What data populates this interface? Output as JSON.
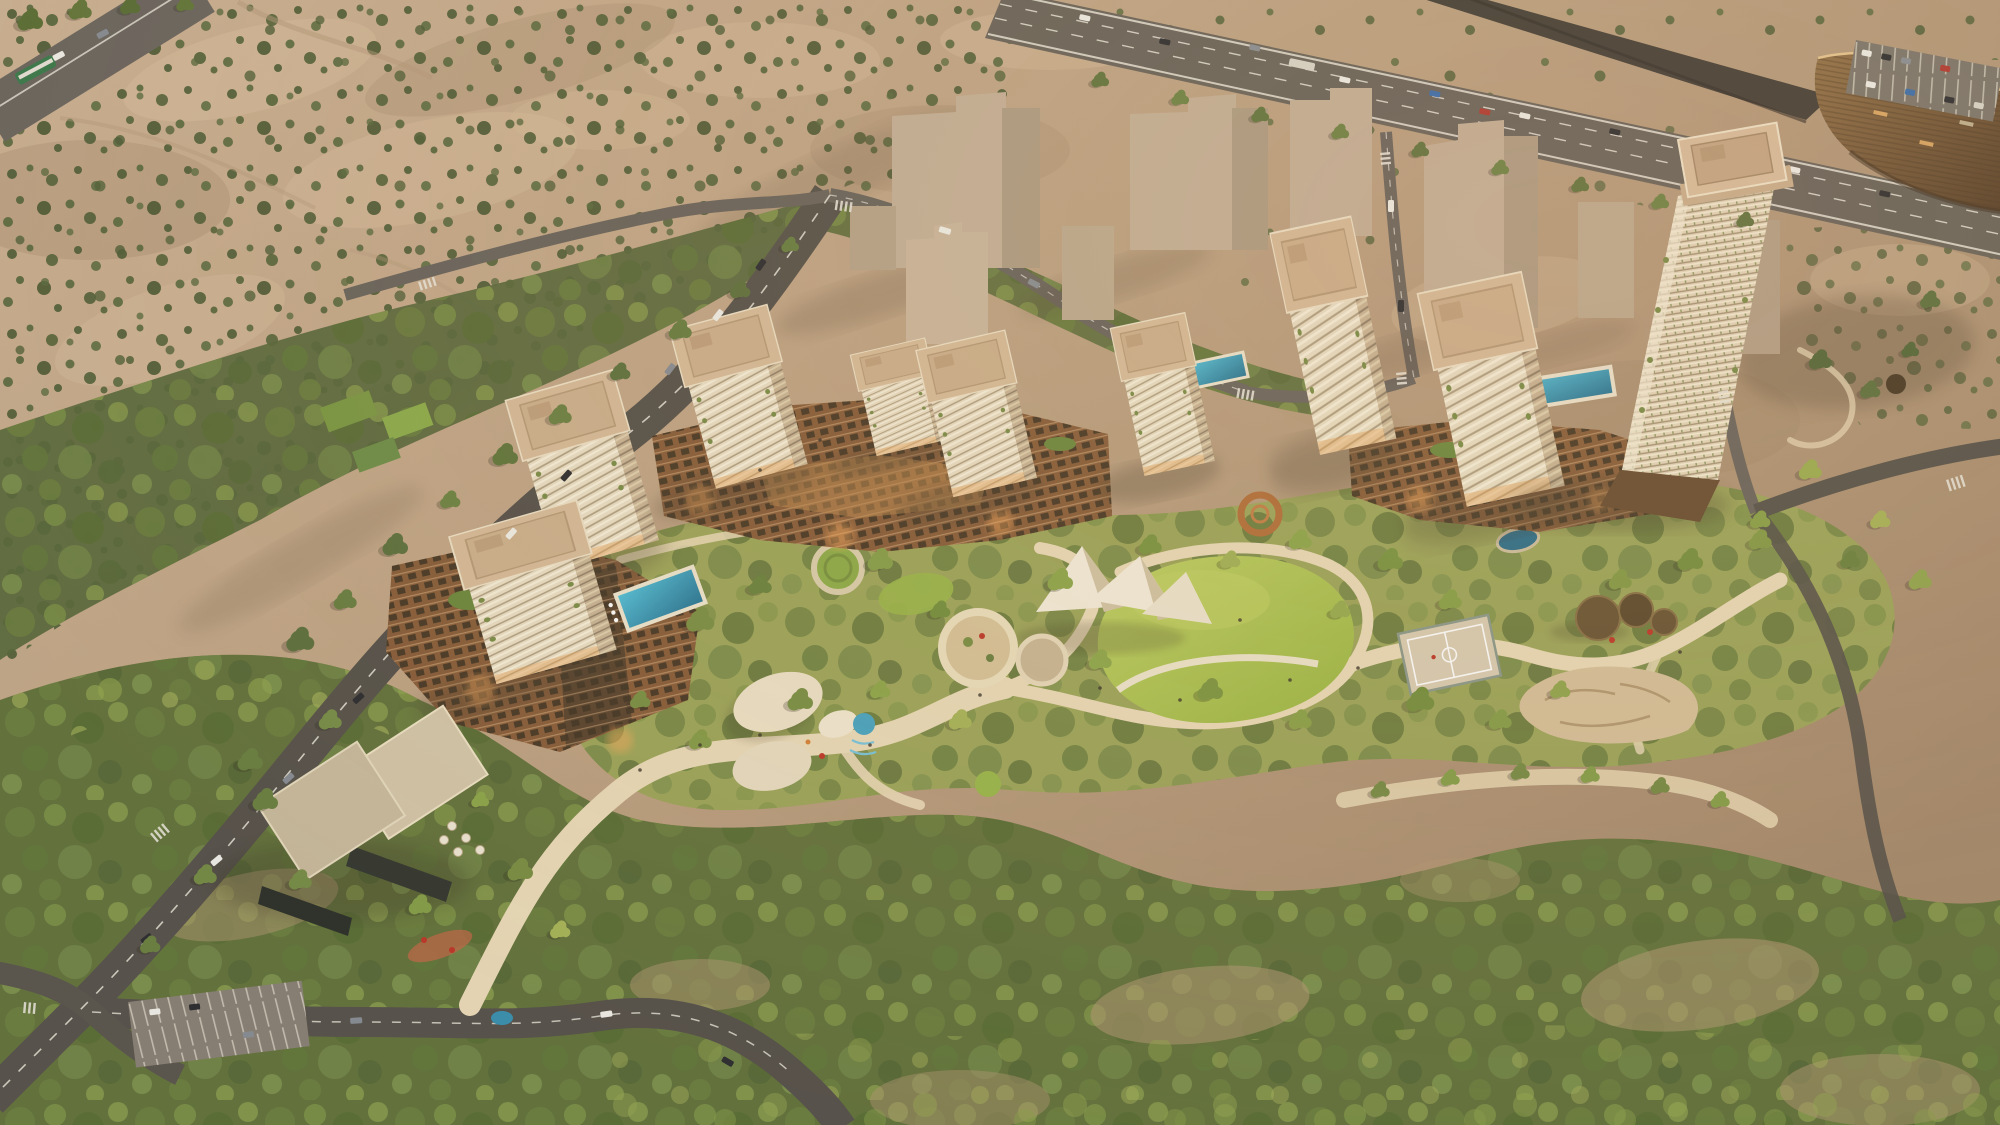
{
  "meta": {
    "kind": "architectural-aerial-render",
    "time_of_day": "sunset",
    "subject": "residential masterplan: cream towers and brown podium blocks around a central landscaped park, surrounded by desert scrubland, a highway with an angular bronze venue building at top right, tree-lined boulevards and dense scrub forest at the bottom"
  },
  "palette": {
    "sand_light": "#cfb496",
    "sand": "#bfa384",
    "sand_dark": "#a78b6e",
    "sand_pink": "#dabf9f",
    "scrub": "#5b6a3e",
    "forest": "#66753f",
    "park_base": "#9fa75c",
    "lawn": "#9cb845",
    "lawn_light": "#c2d266",
    "path": "#ecdcba",
    "plaza": "#d9cbaa",
    "road": "#59544d",
    "road_light": "#6e6861",
    "marking": "#eae6db",
    "highway": "#6b655d",
    "ramp": "#45403a",
    "facade": "#ece0c6",
    "facade_shade": "#cbb697",
    "roof": "#d9bd9b",
    "roof_inner": "#cfb28f",
    "roof_pink": "#dcc0a0",
    "podium": "#8a5f3c",
    "podium_glow": "#ffae5e",
    "massing": "#c7b29a",
    "massing_side": "#b19e86",
    "pool_light": "#53c0da",
    "pool_deep": "#2a7898",
    "water": "#2f6f8c",
    "canopy": "#f5eedd",
    "canopy_shade": "#d4c6a6",
    "arena_light": "#97744b",
    "arena_dark": "#5a412b",
    "school_roof": "#d6c7ab",
    "school_dark": "#373a33",
    "shadow": "#5d4d3a",
    "tree_green": "#74883f",
    "tree_dark": "#5d7038",
    "tree_light": "#8fa44c"
  },
  "scene": {
    "regions": [
      "desert-scrubland",
      "northwest-green-belt",
      "south-forest",
      "central-park"
    ],
    "buildings": [
      "left-tower-pair",
      "center-tower-trio",
      "mid-tower",
      "slim-tower",
      "right-tower",
      "tall-tower",
      "podium-left",
      "podium-center",
      "podium-right",
      "massing-blocks",
      "school-building",
      "arena-building"
    ],
    "park_features": [
      "great-lawn",
      "tensile-canopy",
      "play-pebbles",
      "splash-pad",
      "playground-ring",
      "plaza-circle",
      "green-ring",
      "rust-ring",
      "basketball-court",
      "skate-park",
      "shade-pavilions",
      "pond",
      "rooftop-pools"
    ],
    "infrastructure": [
      "highway",
      "highway-ramp",
      "main-avenue",
      "south-road",
      "local-streets",
      "parking-lots",
      "crosswalks",
      "vehicles"
    ]
  }
}
